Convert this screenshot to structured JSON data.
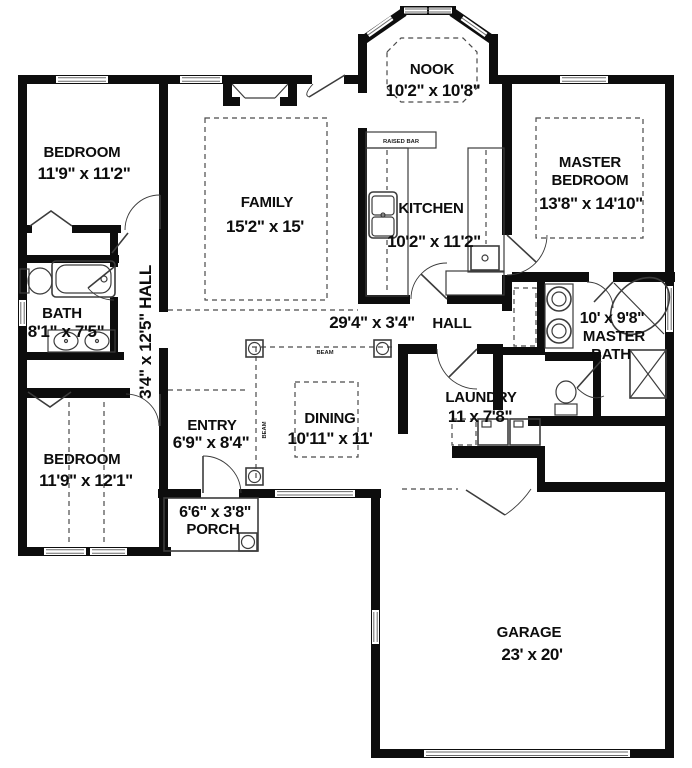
{
  "plan": {
    "rooms": {
      "bedroom1": {
        "name": "BEDROOM",
        "dims": "11'9\" x 11'2\""
      },
      "family": {
        "name": "FAMILY",
        "dims": "15'2\" x 15'"
      },
      "nook": {
        "name": "NOOK",
        "dims": "10'2\" x 10'8\""
      },
      "kitchen": {
        "name": "KITCHEN",
        "dims": "10'2\" x 11'2\""
      },
      "master_bedroom": {
        "name_line1": "MASTER",
        "name_line2": "BEDROOM",
        "dims": "13'8\" x 14'10\""
      },
      "bath": {
        "name": "BATH",
        "dims": "8'1\" x 7'5\""
      },
      "hall_vertical": {
        "label": "3'4\" x 12'5\" HALL"
      },
      "hall": {
        "name": "HALL",
        "dims": "29'4\" x 3'4\""
      },
      "bedroom2": {
        "name": "BEDROOM",
        "dims": "11'9\" x 12'1\""
      },
      "entry": {
        "name": "ENTRY",
        "dims": "6'9\" x 8'4\""
      },
      "dining": {
        "name": "DINING",
        "dims": "10'11\" x 11'"
      },
      "laundry": {
        "name": "LAUNDRY",
        "dims": "11 x 7'8\""
      },
      "master_bath": {
        "dims": "10' x 9'8\"",
        "name_line1": "MASTER",
        "name_line2": "BATH"
      },
      "porch": {
        "dims": "6'6\" x 3'8\"",
        "name": "PORCH"
      },
      "garage": {
        "name": "GARAGE",
        "dims": "23' x 20'"
      }
    },
    "annotations": {
      "raised_bar": "RAISED BAR",
      "beam_top": "BEAM",
      "beam_left": "BEAM"
    },
    "colors": {
      "wall": "#0d0d0d",
      "thin_line": "#3c3c3c",
      "background": "#ffffff"
    }
  }
}
